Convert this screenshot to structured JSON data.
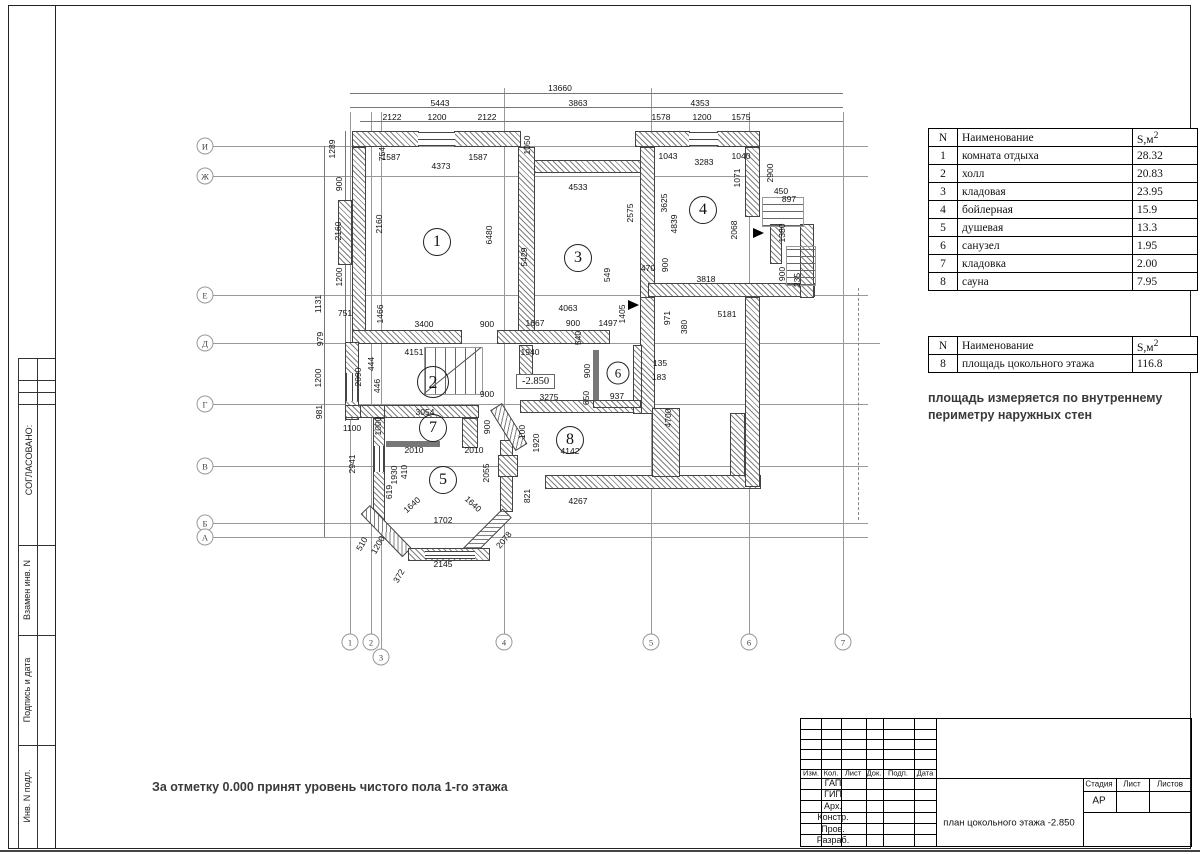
{
  "side_strip": {
    "approved": "СОГЛАСОВАНО:",
    "sections": [
      "Взамен инв. N",
      "Подпись и дата",
      "Инв. N подл."
    ]
  },
  "rooms_table": {
    "headers": [
      "N",
      "Наименование",
      "S,м"
    ],
    "sup": "2",
    "rows": [
      [
        "1",
        "комната отдыха",
        "28.32"
      ],
      [
        "2",
        "холл",
        "20.83"
      ],
      [
        "3",
        "кладовая",
        "23.95"
      ],
      [
        "4",
        "бойлерная",
        "15.9"
      ],
      [
        "5",
        "душевая",
        "13.3"
      ],
      [
        "6",
        "санузел",
        "1.95"
      ],
      [
        "7",
        "кладовка",
        "2.00"
      ],
      [
        "8",
        "сауна",
        "7.95"
      ]
    ]
  },
  "area_table": {
    "headers": [
      "N",
      "Наименование",
      "S,м"
    ],
    "sup": "2",
    "rows": [
      [
        "8",
        "площадь цокольного этажа",
        "116.8"
      ]
    ]
  },
  "notes": {
    "area_note": "площадь измеряется по внутреннему периметру наружных стен",
    "level_note": "За отметку 0.000 принят уровень чистого пола 1-го этажа"
  },
  "title_block": {
    "header_cells": [
      "Изм.",
      "Кол.",
      "Лист",
      "Док.",
      "Подп.",
      "Дата"
    ],
    "role_rows": [
      "ГАП",
      "ГИП",
      "Арх.",
      "Констр.",
      "Пров.",
      "Разраб."
    ],
    "stage_headers": [
      "Стадия",
      "Лист",
      "Листов"
    ],
    "stage_value": "АР",
    "doc_title": "план цокольного этажа -2.850"
  },
  "plan": {
    "elevation": "-2.850",
    "axis_letters": [
      [
        "И",
        146
      ],
      [
        "Ж",
        176
      ],
      [
        "Е",
        295
      ],
      [
        "Д",
        343
      ],
      [
        "Г",
        404
      ],
      [
        "В",
        466
      ],
      [
        "Б",
        523
      ],
      [
        "А",
        537
      ]
    ],
    "axis_numbers": [
      [
        "1",
        350,
        642
      ],
      [
        "2",
        371,
        642
      ],
      [
        "3",
        381,
        657
      ],
      [
        "4",
        504,
        642
      ],
      [
        "5",
        651,
        642
      ],
      [
        "6",
        749,
        642
      ],
      [
        "7",
        843,
        642
      ]
    ],
    "room_circles": [
      [
        "1",
        437,
        242,
        26
      ],
      [
        "2",
        433,
        382,
        30
      ],
      [
        "3",
        578,
        258,
        26
      ],
      [
        "4",
        703,
        210,
        26
      ],
      [
        "5",
        443,
        480,
        26
      ],
      [
        "6",
        618,
        373,
        21
      ],
      [
        "7",
        433,
        428,
        26
      ],
      [
        "8",
        570,
        440,
        26
      ]
    ],
    "dim_labels": [
      [
        "13660",
        560,
        88,
        0
      ],
      [
        "5443",
        440,
        103,
        0
      ],
      [
        "3863",
        578,
        103,
        0
      ],
      [
        "4353",
        700,
        103,
        0
      ],
      [
        "2122",
        392,
        117,
        0
      ],
      [
        "1200",
        437,
        117,
        0
      ],
      [
        "2122",
        487,
        117,
        0
      ],
      [
        "1578",
        661,
        117,
        0
      ],
      [
        "1200",
        702,
        117,
        0
      ],
      [
        "1575",
        741,
        117,
        0
      ],
      [
        "1050",
        527,
        145,
        -90
      ],
      [
        "1587",
        391,
        157,
        0
      ],
      [
        "4373",
        441,
        166,
        0
      ],
      [
        "1587",
        478,
        157,
        0
      ],
      [
        "1043",
        668,
        156,
        0
      ],
      [
        "3283",
        704,
        162,
        0
      ],
      [
        "1040",
        741,
        156,
        0
      ],
      [
        "1289",
        332,
        149,
        -90
      ],
      [
        "754",
        382,
        154,
        -90
      ],
      [
        "900",
        339,
        184,
        -90
      ],
      [
        "2160",
        338,
        231,
        -90
      ],
      [
        "2160",
        379,
        224,
        -90
      ],
      [
        "1200",
        339,
        277,
        -90
      ],
      [
        "1131",
        318,
        304,
        -90
      ],
      [
        "979",
        320,
        339,
        -90
      ],
      [
        "1200",
        318,
        378,
        -90
      ],
      [
        "981",
        319,
        412,
        -90
      ],
      [
        "1071",
        737,
        178,
        -90
      ],
      [
        "2900",
        770,
        173,
        -90
      ],
      [
        "450",
        781,
        191,
        0
      ],
      [
        "897",
        789,
        199,
        0
      ],
      [
        "1380",
        782,
        233,
        -90
      ],
      [
        "2068",
        734,
        230,
        -90
      ],
      [
        "4533",
        578,
        187,
        0
      ],
      [
        "2575",
        630,
        213,
        -90
      ],
      [
        "3625",
        664,
        203,
        -90
      ],
      [
        "4839",
        674,
        224,
        -90
      ],
      [
        "6480",
        489,
        235,
        -90
      ],
      [
        "5429",
        524,
        257,
        -90
      ],
      [
        "549",
        607,
        275,
        -90
      ],
      [
        "470",
        648,
        268,
        0
      ],
      [
        "900",
        665,
        265,
        -90
      ],
      [
        "3818",
        706,
        279,
        0
      ],
      [
        "900",
        782,
        274,
        -90
      ],
      [
        "235",
        797,
        280,
        -90
      ],
      [
        "5181",
        727,
        314,
        0
      ],
      [
        "971",
        667,
        318,
        -90
      ],
      [
        "380",
        684,
        327,
        -90
      ],
      [
        "751",
        345,
        313,
        0
      ],
      [
        "1466",
        380,
        314,
        -90
      ],
      [
        "3400",
        424,
        324,
        0
      ],
      [
        "900",
        487,
        324,
        0
      ],
      [
        "1667",
        535,
        323,
        0
      ],
      [
        "900",
        573,
        323,
        0
      ],
      [
        "1497",
        608,
        323,
        0
      ],
      [
        "1405",
        622,
        314,
        -90
      ],
      [
        "4063",
        568,
        308,
        0
      ],
      [
        "540",
        578,
        338,
        -90
      ],
      [
        "4151",
        414,
        352,
        0
      ],
      [
        "1940",
        530,
        352,
        0
      ],
      [
        "444",
        371,
        364,
        -90
      ],
      [
        "446",
        377,
        386,
        -90
      ],
      [
        "2090",
        358,
        377,
        -90
      ],
      [
        "900",
        587,
        371,
        -90
      ],
      [
        "650",
        586,
        398,
        -90
      ],
      [
        "937",
        617,
        396,
        0
      ],
      [
        "3275",
        549,
        397,
        0
      ],
      [
        "135",
        660,
        363,
        0
      ],
      [
        "183",
        659,
        377,
        0
      ],
      [
        "4700",
        668,
        418,
        -90
      ],
      [
        "900",
        487,
        394,
        0
      ],
      [
        "3054",
        425,
        412,
        0
      ],
      [
        "1000",
        378,
        426,
        -90
      ],
      [
        "900",
        487,
        427,
        -90
      ],
      [
        "1100",
        352,
        428,
        0
      ],
      [
        "100",
        522,
        432,
        -90
      ],
      [
        "1920",
        536,
        443,
        -90
      ],
      [
        "4142",
        570,
        451,
        0
      ],
      [
        "2010",
        414,
        450,
        0
      ],
      [
        "2010",
        474,
        450,
        0
      ],
      [
        "410",
        404,
        472,
        -90
      ],
      [
        "1930",
        394,
        475,
        -90
      ],
      [
        "619",
        389,
        492,
        -90
      ],
      [
        "2055",
        486,
        473,
        -90
      ],
      [
        "2941",
        352,
        464,
        -90
      ],
      [
        "1640",
        412,
        505,
        -42
      ],
      [
        "1640",
        473,
        504,
        42
      ],
      [
        "1702",
        443,
        520,
        0
      ],
      [
        "821",
        527,
        496,
        -90
      ],
      [
        "4267",
        578,
        501,
        0
      ],
      [
        "2145",
        443,
        564,
        0
      ],
      [
        "510",
        362,
        544,
        -60
      ],
      [
        "1200",
        378,
        545,
        -60
      ],
      [
        "372",
        399,
        576,
        -60
      ],
      [
        "2078",
        504,
        540,
        -50
      ]
    ]
  }
}
